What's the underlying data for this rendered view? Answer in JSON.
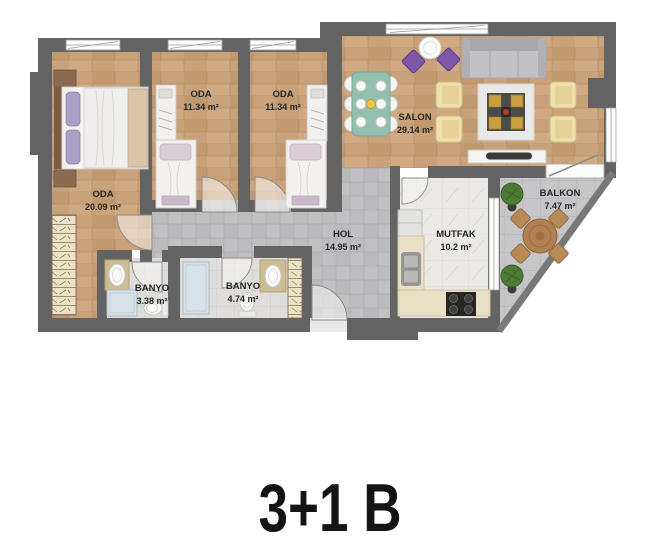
{
  "plan": {
    "title": "3+1 B",
    "rooms": [
      {
        "key": "bedroom-1",
        "name": "ODA",
        "area": "20.09 m²"
      },
      {
        "key": "bedroom-2",
        "name": "ODA",
        "area": "11.34 m²"
      },
      {
        "key": "bedroom-3",
        "name": "ODA",
        "area": "11.34 m²"
      },
      {
        "key": "living-room",
        "name": "SALON",
        "area": "29.14 m²"
      },
      {
        "key": "hall",
        "name": "HOL",
        "area": "14.95 m²"
      },
      {
        "key": "kitchen",
        "name": "MUTFAK",
        "area": "10.2 m²"
      },
      {
        "key": "bathroom-1",
        "name": "BANYO",
        "area": "3.38 m²"
      },
      {
        "key": "bathroom-2",
        "name": "BANYO",
        "area": "4.74 m²"
      },
      {
        "key": "balcony",
        "name": "BALKON",
        "area": "7.47 m²"
      }
    ],
    "colors": {
      "wall": "#636363",
      "wood_floor": "#c9a27b",
      "hall_tile": "#c0c0c2",
      "kitchen_tile": "#ebe9e6",
      "bath_tile": "#dedddb",
      "balcony_tile": "#c6c6c8",
      "accent_purple": "#7e57a8",
      "accent_teal": "#92bfae",
      "accent_cream": "#eedfae",
      "accent_gold": "#c99f3f",
      "label_text": "#262626",
      "title_text": "#141414"
    }
  }
}
